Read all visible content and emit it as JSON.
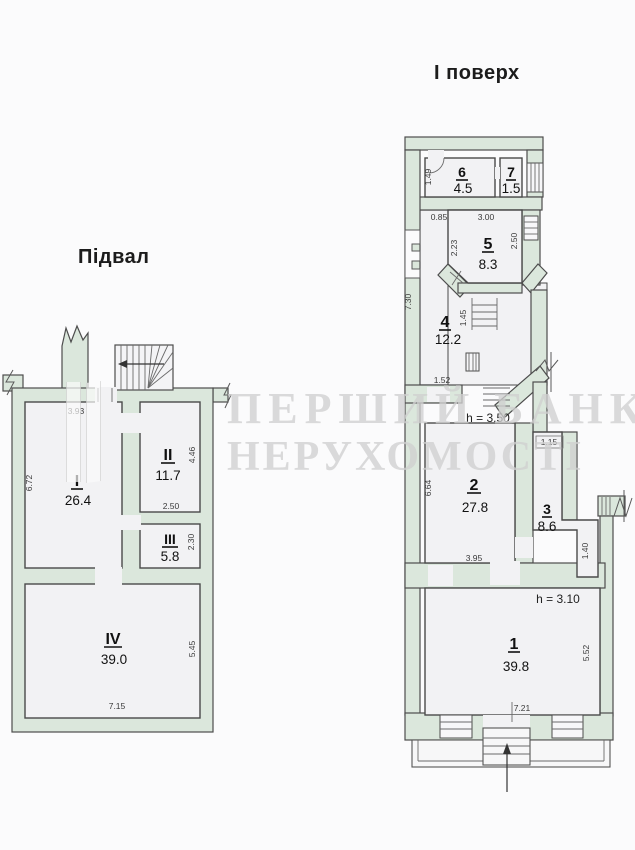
{
  "watermark": {
    "line1": "ПЕРШИЙ БАНК",
    "line2": "НЕРУХОМОСТІ"
  },
  "plans": {
    "basement": {
      "title": "Підвал",
      "rooms": {
        "room1": {
          "number": "I",
          "area": "26.4"
        },
        "room2": {
          "number": "II",
          "area": "11.7"
        },
        "room3": {
          "number": "III",
          "area": "5.8"
        },
        "room4": {
          "number": "IV",
          "area": "39.0"
        }
      },
      "dims": {
        "room1_top": "3.93",
        "room1_left": "6.72",
        "room2_right": "4.46",
        "room2_bottom": "2.50",
        "room3_right": "2.30",
        "room4_right": "5.45",
        "room4_bottom": "7.15"
      }
    },
    "first_floor": {
      "title": "І поверх",
      "rooms": {
        "room1": {
          "number": "1",
          "area": "39.8"
        },
        "room2": {
          "number": "2",
          "area": "27.8"
        },
        "room3": {
          "number": "3",
          "area": "8.6"
        },
        "room4": {
          "number": "4",
          "area": "12.2"
        },
        "room5": {
          "number": "5",
          "area": "8.3"
        },
        "room6": {
          "number": "6",
          "area": "4.5"
        },
        "room7": {
          "number": "7",
          "area": "1.5"
        }
      },
      "heights": {
        "room2": "h = 3.50",
        "room1": "h = 3.10"
      },
      "dims": {
        "room6_left": "1.49",
        "wall_top": "0.85",
        "room5_top": "3.00",
        "room5_left": "2.23",
        "room5_right": "2.50",
        "room4_left": "7.30",
        "stair_width": "1.45",
        "room4_bottom": "1.52",
        "room3_top": "1.15",
        "room2_left": "6.64",
        "room2_bottom": "3.95",
        "room3_right": "1.40",
        "room1_right": "5.52",
        "room1_bottom": "7.21"
      }
    }
  }
}
